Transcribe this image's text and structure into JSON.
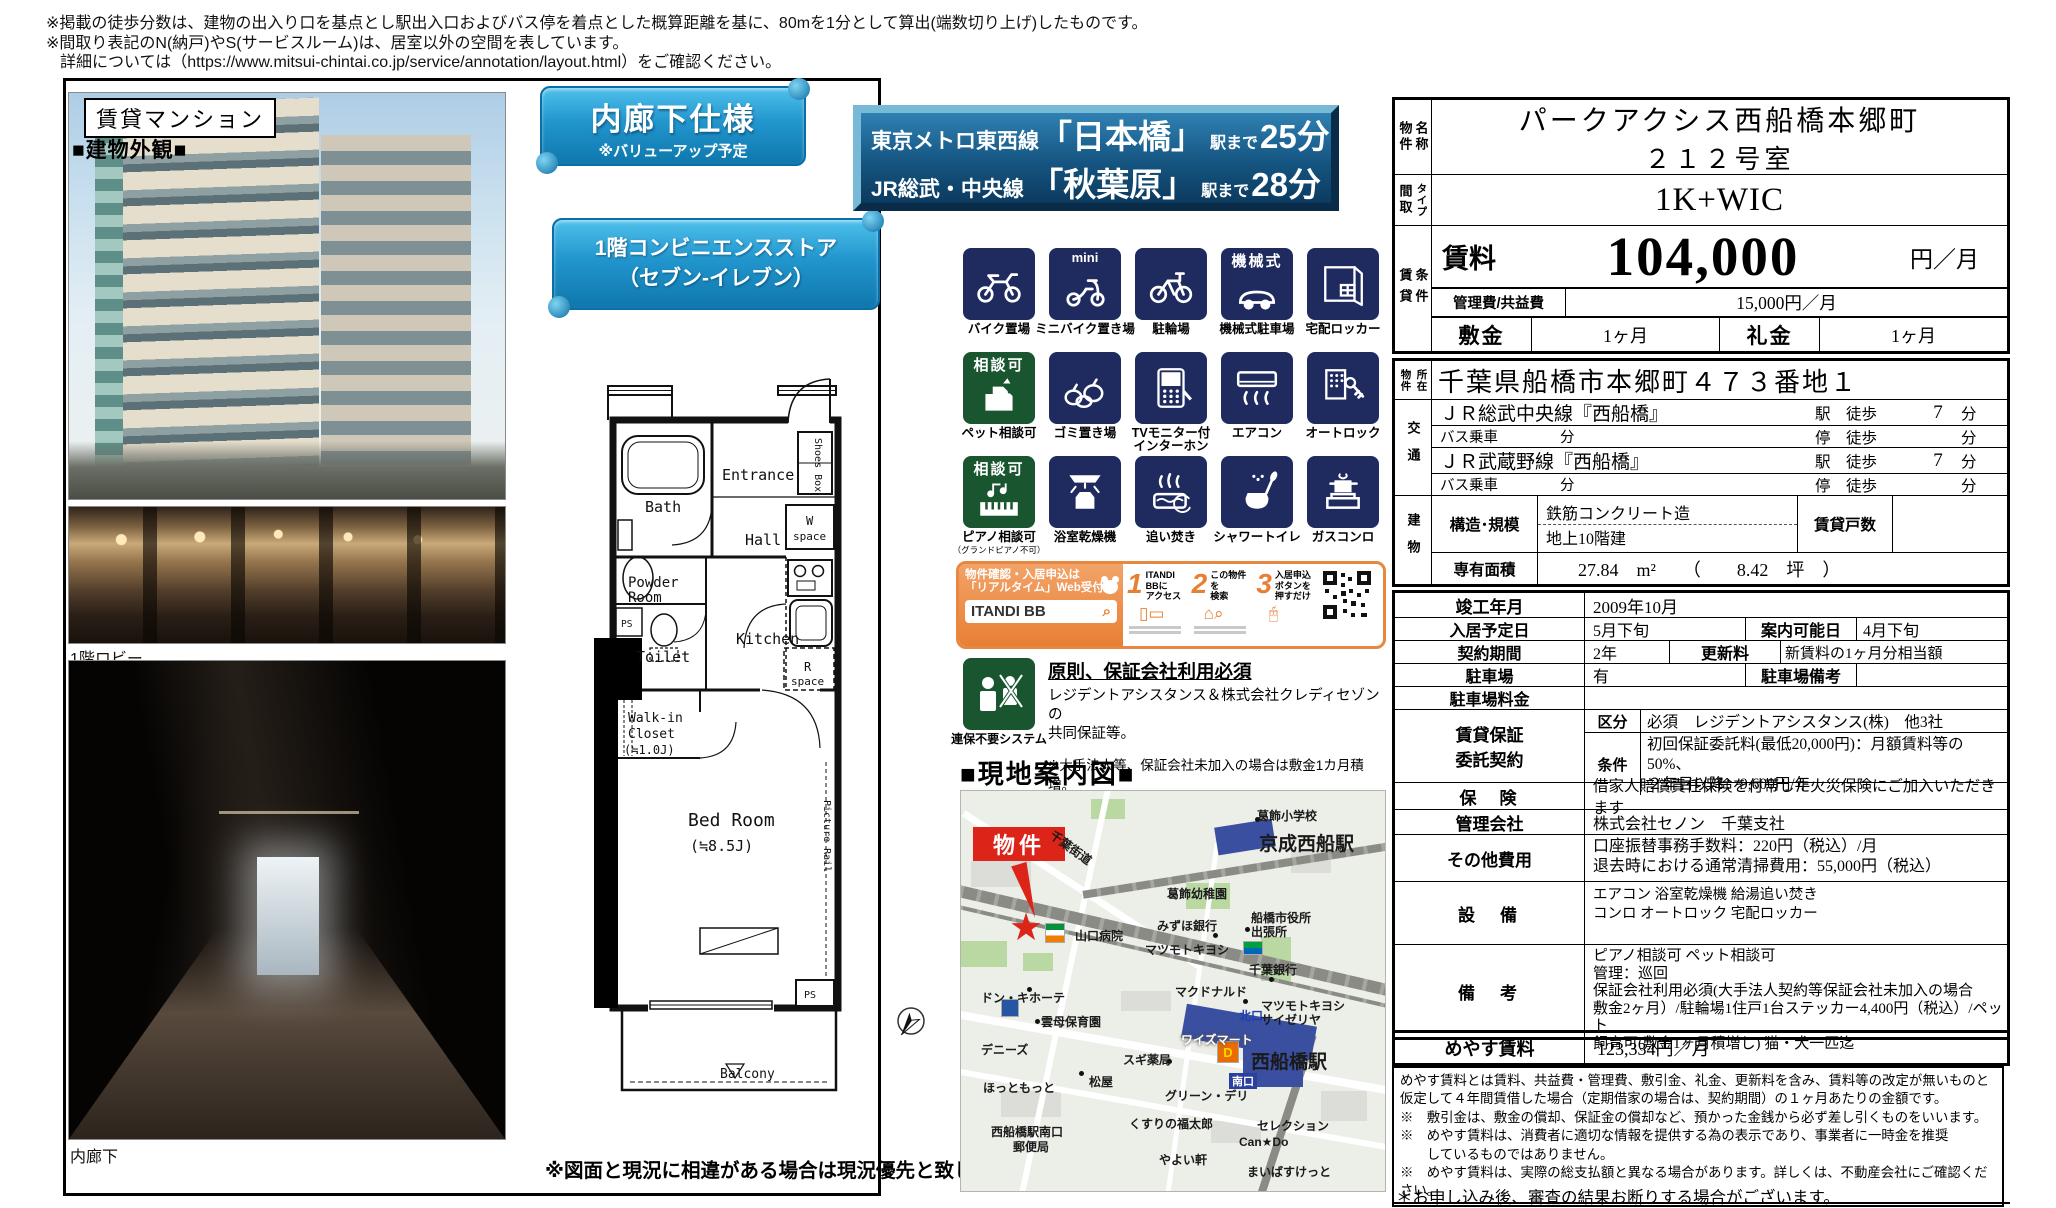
{
  "notes": {
    "line1": "※掲載の徒歩分数は、建物の出入り口を基点とし駅出入口およびバス停を着点とした概算距離を基に、80mを1分として算出(端数切り上げ)したものです。",
    "line2": "※間取り表記のN(納戸)やS(サービスルーム)は、居室以外の空間を表しています。",
    "line3": "詳細については（https://www.mitsui-chintai.co.jp/service/annotation/layout.html）をご確認ください。"
  },
  "left": {
    "badge": "賃貸マンション",
    "exterior": "■建物外観■",
    "lobby": "1階ロビー",
    "corridor": "内廊下"
  },
  "banners": {
    "b1_title": "内廊下仕様",
    "b1_sub": "※バリューアップ予定",
    "b2_line1": "1階コンビニエンスストア",
    "b2_line2": "（セブン-イレブン）",
    "access": [
      {
        "line": "東京メトロ東西線",
        "station": "「日本橋」",
        "to": "駅まで",
        "min": "25分"
      },
      {
        "line": "JR総武・中央線",
        "station": "「秋葉原」",
        "to": "駅まで",
        "min": "28分"
      }
    ]
  },
  "floorplan": {
    "entrance": "Entrance",
    "shoes": "Shoes Box",
    "bath": "Bath",
    "hall": "Hall",
    "w": "W",
    "space1": "space",
    "powder": "Powder",
    "room": "Room",
    "ps_top": "PS",
    "toilet": "Toilet",
    "kitchen": "Kitchen",
    "r": "R",
    "space2": "space",
    "walkin1": "Walk-in",
    "walkin2": "Closet",
    "walkin3": "(≒1.0J)",
    "bed1": "Bed Room",
    "bed2": "(≒8.5J)",
    "rail": "Picture Rail",
    "balcony": "Balcony",
    "ps_bottom": "PS",
    "note": "※図面と現況に相違がある場合は現況優先と致します。"
  },
  "icons": [
    {
      "badge": "",
      "label": "バイク置場"
    },
    {
      "badge": "mini",
      "label": "ミニバイク置き場"
    },
    {
      "badge": "",
      "label": "駐輪場"
    },
    {
      "badge": "機械式",
      "label": "機械式駐車場"
    },
    {
      "badge": "",
      "label": "宅配ロッカー"
    },
    {
      "badge": "相談可",
      "label": "ペット相談可"
    },
    {
      "badge": "",
      "label": "ゴミ置き場"
    },
    {
      "badge": "",
      "label": "TVモニター付",
      "label2": "インターホン"
    },
    {
      "badge": "",
      "label": "エアコン"
    },
    {
      "badge": "",
      "label": "オートロック"
    },
    {
      "badge": "相談可",
      "label": "ピアノ相談可",
      "sub": "（グランドピアノ不可）"
    },
    {
      "badge": "",
      "label": "浴室乾燥機"
    },
    {
      "badge": "",
      "label": "追い焚き"
    },
    {
      "badge": "",
      "label": "シャワートイレ"
    },
    {
      "badge": "",
      "label": "ガスコンロ"
    }
  ],
  "itandi": {
    "head1": "物件確認・入居申込は",
    "head2": "「リアルタイム」Web受付",
    "logo": "ITANDI BB",
    "steps": [
      {
        "n": "1",
        "t1": "ITANDI BBに",
        "t2": "アクセス"
      },
      {
        "n": "2",
        "t1": "この物件を",
        "t2": "検索"
      },
      {
        "n": "3",
        "t1": "入居申込ボタンを",
        "t2": "押すだけ"
      }
    ]
  },
  "guarantor": {
    "icon_label": "連保不要システム",
    "title": "原則、保証会社利用必須",
    "body1": "レジデントアシスタンス＆株式会社クレディセゾンの",
    "body2": "共同保証等。",
    "note": "※大手法人等、保証会社未加入の場合は敷金1カ月積増。"
  },
  "map": {
    "heading": "■現地案内図■",
    "labels": [
      "葛飾小学校",
      "京成西船駅",
      "千葉街道",
      "物件",
      "葛飾幼稚園",
      "みずほ銀行",
      "船橋市役所",
      "出張所",
      "山口病院",
      "マツモトキヨシ",
      "千葉銀行",
      "マクドナルド",
      "ドン・キホーテ",
      "雲母保育園",
      "北口",
      "マツモトキヨシ",
      "サイゼリヤ",
      "デニーズ",
      "ワイズマート",
      "西船橋駅",
      "スギ薬局",
      "松屋",
      "ほっともっと",
      "南口",
      "グリーン・デリ",
      "西船橋駅南口",
      "郵便局",
      "くすりの福太郎",
      "セレクション",
      "Can★Do",
      "やよい軒",
      "まいばすけっと"
    ]
  },
  "table": {
    "h_name1": "物件",
    "h_name2": "名称",
    "name1": "パークアクシス西船橋本郷町",
    "name2": "２１２号室",
    "h_madori": "間取",
    "h_type": "タイプ",
    "layout": "1K+WIC",
    "h_chin": "賃貸",
    "h_joken": "条件",
    "rent_label": "賃料",
    "rent": "104,000",
    "rent_unit": "円／月",
    "kanri_label": "管理費/共益費",
    "kanri": "15,000円／月",
    "shiki_label": "敷金",
    "shiki": "1ヶ月",
    "rei_label": "礼金",
    "rei": "1ヶ月",
    "h_sho1": "物件",
    "h_sho2": "所在",
    "address": "千葉県船橋市本郷町４７３番地１",
    "h_kotsu": "交通",
    "t1_name": "ＪＲ総武中央線『西船橋』",
    "t1_mid": "駅　徒歩",
    "t1_min": "7",
    "t1_unit": "分",
    "t2_name": "バス乗車",
    "t2_m1": "分",
    "t2_mid": "停　徒歩",
    "t2_unit": "分",
    "t3_name": "ＪＲ武蔵野線『西船橋』",
    "t3_mid": "駅　徒歩",
    "t3_min": "7",
    "t3_unit": "分",
    "t4_name": "バス乗車",
    "t4_m1": "分",
    "t4_mid": "停　徒歩",
    "t4_unit": "分",
    "h_tate": "建物",
    "kozo_label": "構造･規模",
    "kozo1": "鉄筋コンクリート造",
    "kozo2": "地上10階建",
    "kosu_label": "賃貸戸数",
    "kosu": "",
    "men_label": "専有面積",
    "men": "27.84　m²　　（　　8.42　坪　）",
    "r1_label": "竣工年月",
    "r1_val": "2009年10月",
    "r2_label": "入居予定日",
    "r2_val": "5月下旬",
    "r2_label2": "案内可能日",
    "r2_val2": "4月下旬",
    "r3_label": "契約期間",
    "r3_val": "2年",
    "r3_label2": "更新料",
    "r3_val2": "新賃料の1ヶ月分相当額",
    "r4_label": "駐車場",
    "r4_val": "有",
    "r4_label2": "駐車場備考",
    "r4_val2": "",
    "r5_label": "駐車場料金",
    "r5_val": "",
    "hosho1": "賃貸保証",
    "hosho2": "委託契約",
    "kubun_label": "区分",
    "kubun": "必須　レジデントアシスタンス(株)　他3社",
    "joken_label": "条件",
    "joken1": "初回保証委託料(最低20,000円)：月額賃料等の50%、",
    "joken2": "２年目以降：9,600円/年",
    "hoken_label": "保　険",
    "hoken": "借家人賠償責任保険を付帯した火災保険にご加入いただきます",
    "kanrikaisha_label": "管理会社",
    "kanrikaisha": "株式会社セノン　千葉支社",
    "sonota_label": "その他費用",
    "sonota1": "口座振替事務手数料：220円（税込）/月",
    "sonota2": "退去時における通常清掃費用：55,000円（税込）",
    "setsubi_label": "設　備",
    "setsubi1": "エアコン 浴室乾燥機 給湯追い焚き",
    "setsubi2": "コンロ オートロック 宅配ロッカー",
    "biko_label": "備　考",
    "biko1": "ピアノ相談可 ペット相談可",
    "biko2": "管理：巡回",
    "biko3": "保証会社利用必須(大手法人契約等保証会社未加入の場合",
    "biko4": "敷金2ヶ月）/駐輪場1住戸1台ステッカー4,400円（税込）/ペット",
    "biko5": "飼育可(敷金1ヶ月積増し) 猫・犬一匹迄"
  },
  "meyasu": {
    "label": "めやす賃料",
    "value": "123,334円／月",
    "l1": "めやす賃料とは賃料、共益費・管理費、敷引金、礼金、更新料を含み、賃料等の改定が無いものと",
    "l2": "仮定して４年間賃借した場合（定期借家の場合は、契約期間）の１ヶ月あたりの金額です。",
    "l3": "※　敷引金は、敷金の償却、保証金の償却など、預かった金銭から必ず差し引くものをいいます。",
    "l4": "※　めやす賃料は、消費者に適切な情報を提供する為の表示であり、事業者に一時金を推奨",
    "l5": "　　しているものではありません。",
    "l6": "※　めやす賃料は、実際の総支払額と異なる場合があります。詳しくは、不動産会社にご確認ください。",
    "footer": "＊お申し込み後、審査の結果お断りする場合がございます。"
  }
}
